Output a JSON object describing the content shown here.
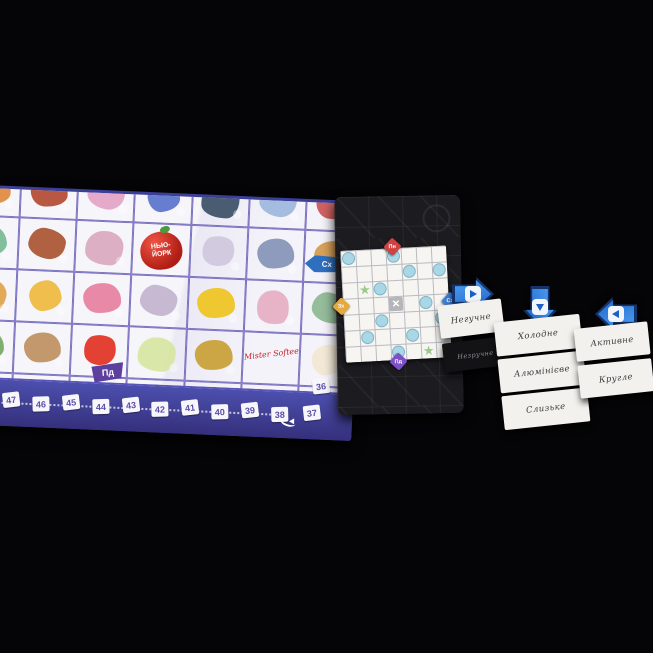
{
  "board": {
    "apple_label": "НЬЮ-ЙОРК",
    "softee_label": "Mister Softee",
    "pennant_label": "Пд",
    "east_badge_label": "Сх",
    "track_numbers": [
      "47",
      "46",
      "45",
      "44",
      "43",
      "42",
      "41",
      "40",
      "39",
      "38"
    ],
    "corner_numbers": [
      "37",
      "36"
    ],
    "tiles": [
      {
        "n": "orange-cat",
        "c": "#e08a3c"
      },
      {
        "n": "brownstone-building",
        "c": "#b34a32"
      },
      {
        "n": "pink-shop",
        "c": "#e3a3c6"
      },
      {
        "n": "blue-bed",
        "c": "#5a72cc"
      },
      {
        "n": "doorman",
        "c": "#3c4f66"
      },
      {
        "n": "chrysler-tower",
        "c": "#9db7dd"
      },
      {
        "n": "kids-playing",
        "c": "#cc5555"
      },
      {
        "n": "statue-of-liberty",
        "c": "#76b894"
      },
      {
        "n": "flatiron-building",
        "c": "#a85432"
      },
      {
        "n": "man-eating",
        "c": "#d9a8bf"
      },
      {
        "n": "apple-new-york",
        "t": "apple",
        "c": "#b01d14"
      },
      {
        "n": "newspaper",
        "c": "#cfc8dc"
      },
      {
        "n": "subway-car",
        "c": "#8494b6"
      },
      {
        "n": "bagel",
        "c": "#d49a4a"
      },
      {
        "n": "hotdog-cart",
        "c": "#dfa24a"
      },
      {
        "n": "yellow-stool",
        "c": "#efb83d"
      },
      {
        "n": "birthday-cake",
        "c": "#e57f9f"
      },
      {
        "n": "pigeon",
        "c": "#c3b3cf"
      },
      {
        "n": "yellow-taxi",
        "c": "#eec31f"
      },
      {
        "n": "lunch-box",
        "c": "#e5afc2"
      },
      {
        "n": "green-monument",
        "c": "#8cb793"
      },
      {
        "n": "chess-players",
        "c": "#74a863"
      },
      {
        "n": "cannoli",
        "c": "#bd8f60"
      },
      {
        "n": "red-lantern",
        "c": "#e03122"
      },
      {
        "n": "martini-glass",
        "c": "#d6e6a2"
      },
      {
        "n": "couple",
        "c": "#c9a035"
      },
      {
        "n": "mister-softee-sign",
        "t": "script",
        "c": "#c4252b"
      },
      {
        "n": "ice-cream-cone",
        "c": "#f2e7d2"
      },
      {
        "n": "bull-statue",
        "c": "#9c6f42"
      },
      {
        "n": "brooklyn-bridge",
        "c": "#bf5a39"
      },
      {
        "n": "pretzel",
        "c": "#a66a38"
      },
      {
        "n": "purple-rock",
        "c": "#6b5bac"
      },
      {
        "n": "delivery-bicycle",
        "c": "#4a79c8"
      },
      {
        "n": "water-wave",
        "c": "#5aa8d8"
      },
      {
        "n": "fire-hydrant",
        "c": "#df382c"
      }
    ]
  },
  "map_card": {
    "grid": {
      "cols": 7,
      "rows": 7
    },
    "markers": {
      "circles": [
        [
          1,
          1
        ],
        [
          4,
          1
        ],
        [
          5,
          2
        ],
        [
          7,
          2
        ],
        [
          3,
          3
        ],
        [
          6,
          4
        ],
        [
          3,
          5
        ],
        [
          7,
          5
        ],
        [
          2,
          6
        ],
        [
          5,
          6
        ],
        [
          4,
          7
        ]
      ],
      "stars": [
        [
          2,
          3
        ],
        [
          6,
          7
        ]
      ],
      "cross": [
        [
          4,
          4
        ]
      ]
    },
    "marker_colors": {
      "circle": "#a9d7e6",
      "star": "#9cc98b",
      "cross": "#b6b6ba"
    },
    "compass": [
      {
        "dir": "north",
        "label": "Пн",
        "color": "#d24141"
      },
      {
        "dir": "east",
        "label": "Сх",
        "color": "#3b7fd6"
      },
      {
        "dir": "south",
        "label": "Пд",
        "color": "#7d4fc9"
      },
      {
        "dir": "west",
        "label": "Зх",
        "color": "#e5a93e"
      }
    ]
  },
  "tokens": [
    {
      "name": "arrow-token-right",
      "direction": "right"
    },
    {
      "name": "arrow-token-down",
      "direction": "down"
    },
    {
      "name": "arrow-token-left",
      "direction": "left"
    }
  ],
  "card_columns": [
    {
      "cards": [
        {
          "label": "Негучне",
          "face": "up"
        },
        {
          "label": "Незручне",
          "face": "down"
        }
      ]
    },
    {
      "cards": [
        {
          "label": "Холодне",
          "face": "up"
        },
        {
          "label": "Алюмінієве",
          "face": "up"
        },
        {
          "label": "Слизьке",
          "face": "up"
        }
      ]
    },
    {
      "cards": [
        {
          "label": "Активне",
          "face": "up"
        },
        {
          "label": "Кругле",
          "face": "up"
        }
      ]
    }
  ]
}
